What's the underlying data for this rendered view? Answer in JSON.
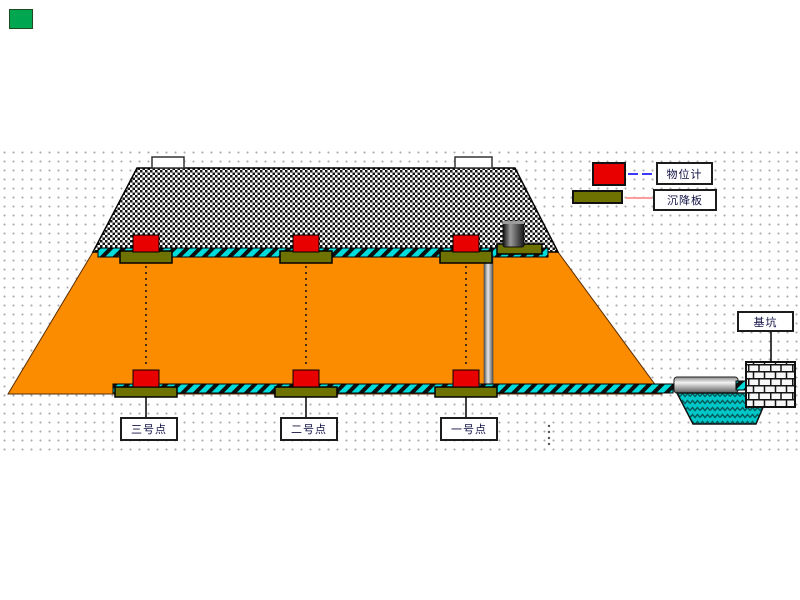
{
  "legend": {
    "items": [
      {
        "label": "物位计",
        "symbol": "level-gauge-red-box",
        "symbol_color": "#E80000",
        "line_color": "#3A3AFF"
      },
      {
        "label": "沉降板",
        "symbol": "settlement-plate-bar",
        "symbol_color": "#6E7200",
        "line_color": "#FF9D9D"
      }
    ]
  },
  "points": [
    {
      "label": "三号点"
    },
    {
      "label": "二号点"
    },
    {
      "label": "一号点"
    }
  ],
  "pit": {
    "label": "基坑"
  },
  "status_indicator": {
    "state": "on",
    "color": "#00A650"
  },
  "colors": {
    "embankment_orange": "#FB8C00",
    "cable_teal": "#00DCDC",
    "plate_olive": "#6E7200",
    "gauge_red": "#E80000",
    "pit_water_teal": "#00C8C8"
  }
}
